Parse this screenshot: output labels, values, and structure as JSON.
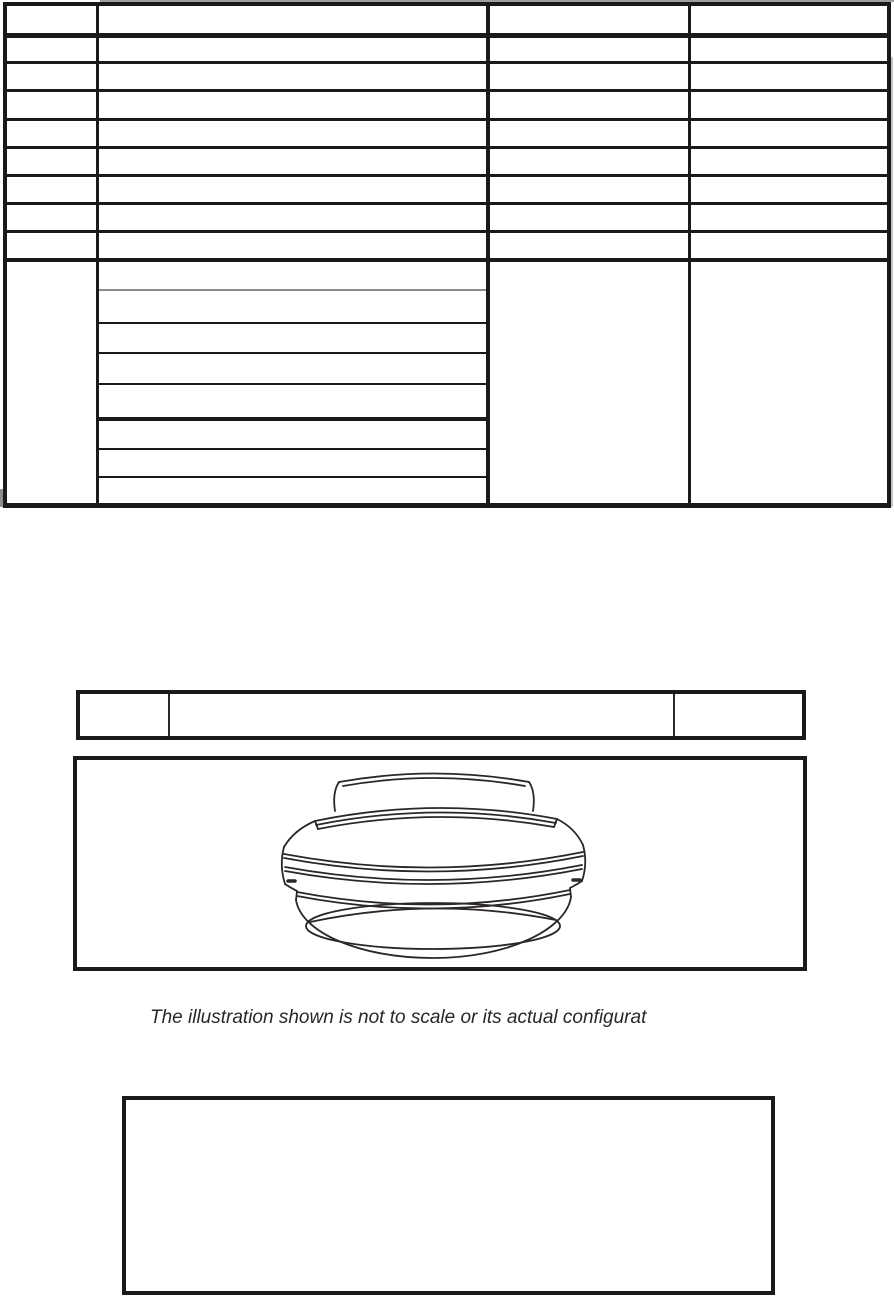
{
  "caption": {
    "text": "The illustration shown is not to scale or its actual configurat"
  },
  "illustration": {
    "subject": "ceiling-mounted round dome fixture, black-and-white line drawing, viewed from below at an angle"
  },
  "colors": {
    "background": "#ffffff",
    "table_lines": "#1a1a1a",
    "gray_sub_divider": "#8c8c8c",
    "caption_text": "#2a2627"
  },
  "top_table": {
    "columns": 4,
    "header_rows": 1,
    "body_rows": 8,
    "detail_row_subrows": 8,
    "cell_text": ""
  },
  "middle_bar": {
    "cells": 3,
    "cell_text": ""
  },
  "bottom_box": {
    "cell_text": ""
  }
}
